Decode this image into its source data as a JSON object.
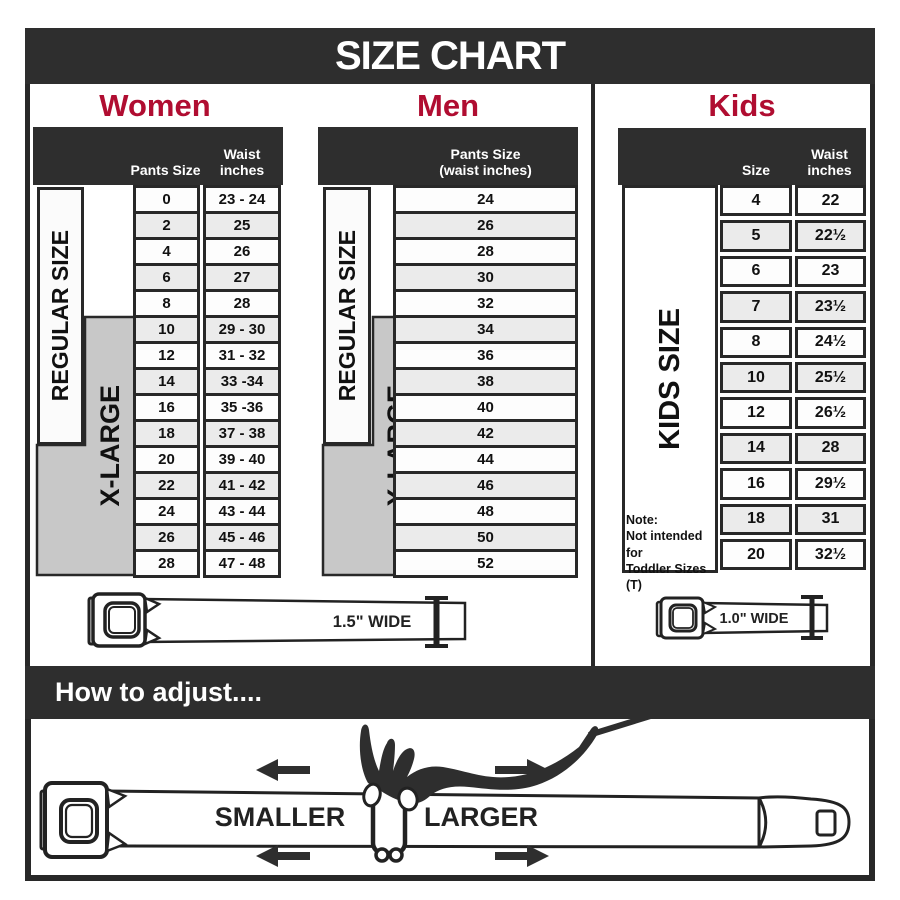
{
  "title": "SIZE CHART",
  "colors": {
    "dark": "#2e2e2e",
    "red": "#b00d31",
    "xlarge_gray": "#c8c8c8",
    "row_alt": "#ebebeb",
    "line": "#222222"
  },
  "sections": {
    "women": {
      "label": "Women",
      "col1_header": "Pants Size",
      "col2_header": [
        "Waist",
        "inches"
      ],
      "regular_label": "REGULAR SIZE",
      "xlarge_label": "X-LARGE",
      "rows": [
        {
          "size": "0",
          "waist": "23 - 24"
        },
        {
          "size": "2",
          "waist": "25"
        },
        {
          "size": "4",
          "waist": "26"
        },
        {
          "size": "6",
          "waist": "27"
        },
        {
          "size": "8",
          "waist": "28"
        },
        {
          "size": "10",
          "waist": "29 - 30"
        },
        {
          "size": "12",
          "waist": "31 - 32"
        },
        {
          "size": "14",
          "waist": "33 -34"
        },
        {
          "size": "16",
          "waist": "35 -36"
        },
        {
          "size": "18",
          "waist": "37 - 38"
        },
        {
          "size": "20",
          "waist": "39 - 40"
        },
        {
          "size": "22",
          "waist": "41 - 42"
        },
        {
          "size": "24",
          "waist": "43 - 44"
        },
        {
          "size": "26",
          "waist": "45 - 46"
        },
        {
          "size": "28",
          "waist": "47 - 48"
        }
      ]
    },
    "men": {
      "label": "Men",
      "header_line1": "Pants Size",
      "header_line2": "(waist inches)",
      "regular_label": "REGULAR SIZE",
      "xlarge_label": "X-LARGE",
      "rows": [
        "24",
        "26",
        "28",
        "30",
        "32",
        "34",
        "36",
        "38",
        "40",
        "42",
        "44",
        "46",
        "48",
        "50",
        "52"
      ]
    },
    "kids": {
      "label": "Kids",
      "col1_header": "Size",
      "col2_header": [
        "Waist",
        "inches"
      ],
      "side_label": "KIDS SIZE",
      "note_lines": [
        "Note:",
        "Not intended for",
        "Toddler Sizes (T)"
      ],
      "rows": [
        {
          "size": "4",
          "waist": "22"
        },
        {
          "size": "5",
          "waist": "22½"
        },
        {
          "size": "6",
          "waist": "23"
        },
        {
          "size": "7",
          "waist": "23½"
        },
        {
          "size": "8",
          "waist": "24½"
        },
        {
          "size": "10",
          "waist": "25½"
        },
        {
          "size": "12",
          "waist": "26½"
        },
        {
          "size": "14",
          "waist": "28"
        },
        {
          "size": "16",
          "waist": "29½"
        },
        {
          "size": "18",
          "waist": "31"
        },
        {
          "size": "20",
          "waist": "32½"
        }
      ]
    }
  },
  "belts": {
    "adult_width_label": "1.5\" WIDE",
    "kids_width_label": "1.0\" WIDE"
  },
  "adjust": {
    "bar_label": "How to adjust....",
    "smaller_label": "SMALLER",
    "larger_label": "LARGER"
  },
  "chart_data": [
    {
      "type": "table",
      "title": "Women",
      "columns": [
        "Pants Size",
        "Waist inches"
      ],
      "rows": [
        [
          "0",
          "23 - 24"
        ],
        [
          "2",
          "25"
        ],
        [
          "4",
          "26"
        ],
        [
          "6",
          "27"
        ],
        [
          "8",
          "28"
        ],
        [
          "10",
          "29 - 30"
        ],
        [
          "12",
          "31 - 32"
        ],
        [
          "14",
          "33 -34"
        ],
        [
          "16",
          "35 -36"
        ],
        [
          "18",
          "37 - 38"
        ],
        [
          "20",
          "39 - 40"
        ],
        [
          "22",
          "41 - 42"
        ],
        [
          "24",
          "43 - 44"
        ],
        [
          "26",
          "45 - 46"
        ],
        [
          "28",
          "47 - 48"
        ]
      ],
      "annotations": [
        "REGULAR SIZE: 0-18",
        "X-LARGE: 10-28",
        "Belt 1.5\" wide"
      ]
    },
    {
      "type": "table",
      "title": "Men",
      "columns": [
        "Pants Size (waist inches)"
      ],
      "rows": [
        [
          "24"
        ],
        [
          "26"
        ],
        [
          "28"
        ],
        [
          "30"
        ],
        [
          "32"
        ],
        [
          "34"
        ],
        [
          "36"
        ],
        [
          "38"
        ],
        [
          "40"
        ],
        [
          "42"
        ],
        [
          "44"
        ],
        [
          "46"
        ],
        [
          "48"
        ],
        [
          "50"
        ],
        [
          "52"
        ]
      ],
      "annotations": [
        "REGULAR SIZE: 24-32",
        "X-LARGE: 34-52",
        "Belt 1.5\" wide"
      ]
    },
    {
      "type": "table",
      "title": "Kids",
      "columns": [
        "Size",
        "Waist inches"
      ],
      "rows": [
        [
          "4",
          "22"
        ],
        [
          "5",
          "22½"
        ],
        [
          "6",
          "23"
        ],
        [
          "7",
          "23½"
        ],
        [
          "8",
          "24½"
        ],
        [
          "10",
          "25½"
        ],
        [
          "12",
          "26½"
        ],
        [
          "14",
          "28"
        ],
        [
          "16",
          "29½"
        ],
        [
          "18",
          "31"
        ],
        [
          "20",
          "32½"
        ]
      ],
      "annotations": [
        "KIDS SIZE",
        "Not intended for Toddler Sizes (T)",
        "Belt 1.0\" wide"
      ]
    }
  ]
}
